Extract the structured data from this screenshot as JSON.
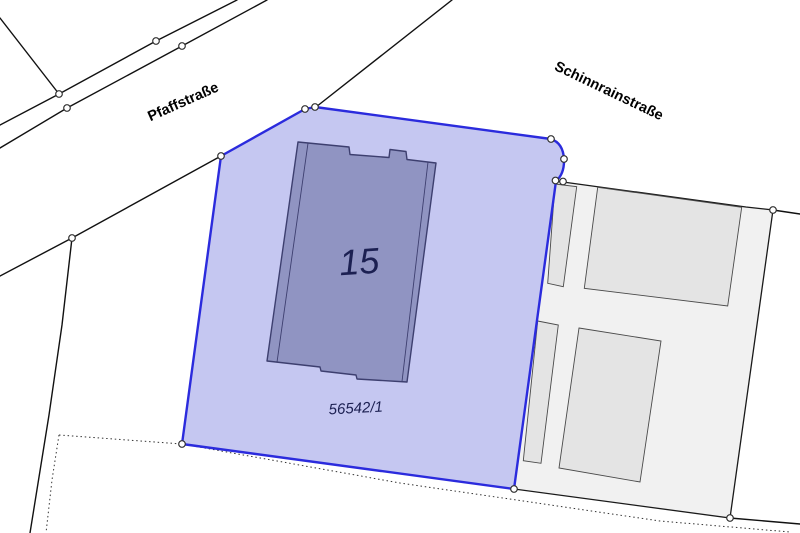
{
  "map": {
    "streets": [
      {
        "name": "Pfaffstraße"
      },
      {
        "name": "Schinnrainstraße"
      }
    ],
    "selected_parcel": {
      "number": "56542/1",
      "house_number": "15"
    },
    "colors": {
      "selected_parcel_fill": "#c5c7f1",
      "selected_parcel_boundary": "#2b2bdd",
      "main_building_fill": "#9094c2",
      "main_building_stroke": "#3d3f6f",
      "neighbor_parcel_fill": "#f1f1f1",
      "neighbor_building_fill": "#e4e4e4",
      "boundary_line": "#111111",
      "label_text": "#1c2052",
      "street_text": "#000000",
      "boundary_point_fill": "#ffffff",
      "background": "#ffffff"
    }
  }
}
